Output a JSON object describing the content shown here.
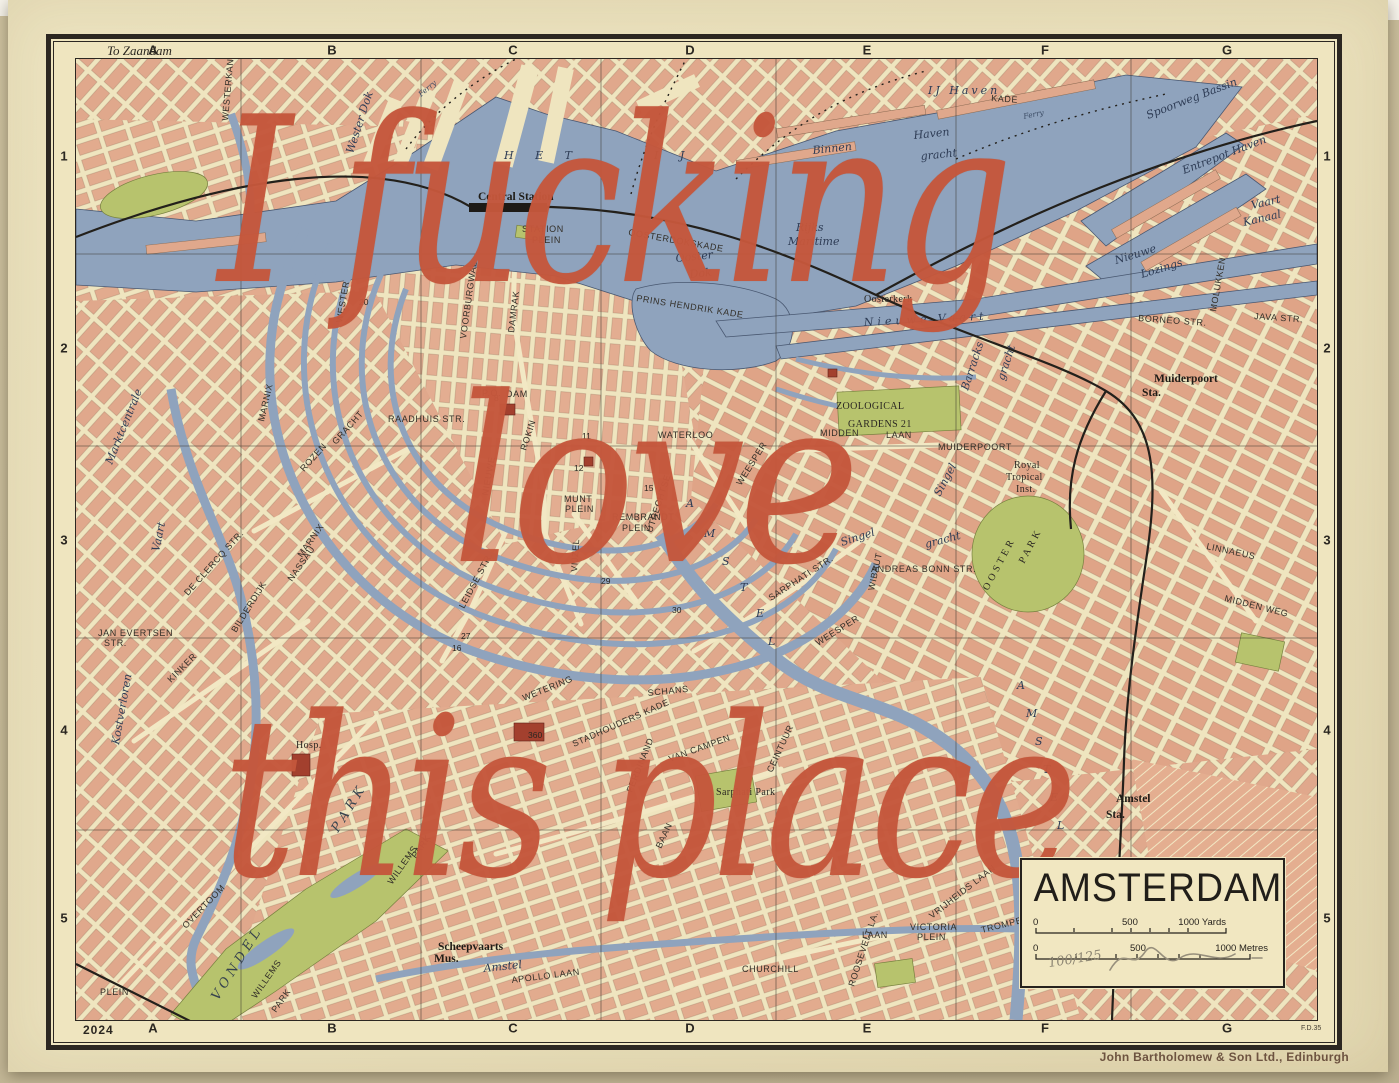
{
  "artwork": {
    "overlay": {
      "line1": "I fucking",
      "line2": "love",
      "line3": "this place"
    },
    "caption": "John Bartholomew & Son Ltd., Edinburgh",
    "edition_number": "100/125"
  },
  "colors": {
    "overlay_accent": "#c5573c",
    "water": "#8fa3bd",
    "building": "#e0a88c",
    "park": "#b7c36d",
    "paper": "#ece3bd",
    "ink": "#2c2721"
  },
  "frame": {
    "to_zaandam": "To Zaandam",
    "plate_year": "2024",
    "plate_ref": "F.D.35",
    "grid_letters": [
      "A",
      "B",
      "C",
      "D",
      "E",
      "F",
      "G"
    ],
    "grid_letter_x": [
      148,
      327,
      508,
      685,
      862,
      1040,
      1222
    ],
    "grid_numbers": [
      "1",
      "2",
      "3",
      "4",
      "5"
    ],
    "grid_number_y": [
      153,
      345,
      537,
      727,
      915
    ]
  },
  "title_box": {
    "title": "AMSTERDAM",
    "yards_zero": "0",
    "yards_mid": "500",
    "yards_end": "1000 Yards",
    "metres_zero": "0",
    "metres_mid": "500",
    "metres_end": "1000 Metres"
  },
  "map_labels": [
    {
      "t": "Wester Dok",
      "x": 277,
      "y": 95,
      "r": -72,
      "f": "w"
    },
    {
      "t": "H E T",
      "x": 428,
      "y": 100,
      "f": "w",
      "s": 15,
      "ls": 9
    },
    {
      "t": "I J",
      "x": 578,
      "y": 100,
      "f": "w",
      "s": 15,
      "ls": 9
    },
    {
      "t": "IJ  Haven",
      "x": 852,
      "y": 35,
      "f": "w",
      "s": 13,
      "ls": 3
    },
    {
      "t": "Ferry",
      "x": 345,
      "y": 38,
      "r": -40,
      "f": "fy"
    },
    {
      "t": "Ferry",
      "x": 948,
      "y": 60,
      "r": -12,
      "f": "fy"
    },
    {
      "t": "KADE",
      "x": 915,
      "y": 42,
      "r": 4,
      "f": "st",
      "s": 7.5
    },
    {
      "t": "Binnen",
      "x": 737,
      "y": 95,
      "r": -6,
      "f": "w"
    },
    {
      "t": "Haven",
      "x": 838,
      "y": 80,
      "r": -6,
      "f": "w"
    },
    {
      "t": "gracht",
      "x": 845,
      "y": 101,
      "r": -6,
      "f": "w"
    },
    {
      "t": "Ooster",
      "x": 600,
      "y": 203,
      "r": -6,
      "f": "w"
    },
    {
      "t": "Dok",
      "x": 614,
      "y": 219,
      "r": -6,
      "f": "w"
    },
    {
      "t": "Rijks",
      "x": 720,
      "y": 172,
      "f": "w"
    },
    {
      "t": "Maritime",
      "x": 712,
      "y": 186,
      "f": "w"
    },
    {
      "t": "Oosterkerk",
      "x": 788,
      "y": 243,
      "f": "sf",
      "s": 9.5
    },
    {
      "t": "Nieuwe    Vaart",
      "x": 788,
      "y": 267,
      "r": -3,
      "f": "w",
      "ls": 4
    },
    {
      "t": "Spoorweg  Bassin",
      "x": 1072,
      "y": 60,
      "r": -21,
      "f": "w"
    },
    {
      "t": "Entrepot  Haven",
      "x": 1108,
      "y": 115,
      "r": -21,
      "f": "w",
      "s": 12
    },
    {
      "t": "Vaart",
      "x": 1176,
      "y": 150,
      "r": -13,
      "f": "w"
    },
    {
      "t": "Kanaal",
      "x": 1168,
      "y": 167,
      "r": -13,
      "f": "w"
    },
    {
      "t": "Nieuwe",
      "x": 1040,
      "y": 205,
      "r": -17,
      "f": "w",
      "s": 10
    },
    {
      "t": "Lozings",
      "x": 1066,
      "y": 219,
      "r": -17,
      "f": "w",
      "s": 10
    },
    {
      "t": "BORNEO  STR.",
      "x": 1062,
      "y": 262,
      "r": 4,
      "f": "st",
      "s": 8
    },
    {
      "t": "JAVA  STR.",
      "x": 1178,
      "y": 260,
      "r": 4,
      "f": "st",
      "s": 8
    },
    {
      "t": "MOLUKKEN",
      "x": 1140,
      "y": 253,
      "r": -80,
      "f": "st",
      "s": 8
    },
    {
      "t": "Central Station",
      "x": 402,
      "y": 141,
      "f": "sfb"
    },
    {
      "t": "STATION",
      "x": 446,
      "y": 173,
      "f": "st",
      "s": 8
    },
    {
      "t": "PLEIN",
      "x": 456,
      "y": 184,
      "f": "st",
      "s": 8
    },
    {
      "t": "OOSTERDOKSKADE",
      "x": 552,
      "y": 176,
      "r": 10,
      "f": "st",
      "s": 7.5
    },
    {
      "t": "PRINS  HENDRIK  KADE",
      "x": 560,
      "y": 242,
      "r": 9,
      "f": "st",
      "s": 8
    },
    {
      "t": "DAMRAK",
      "x": 438,
      "y": 274,
      "r": -83,
      "f": "st"
    },
    {
      "t": "VOORBURGWAL",
      "x": 390,
      "y": 280,
      "r": -82,
      "f": "st",
      "s": 8
    },
    {
      "t": "WESTER",
      "x": 266,
      "y": 264,
      "r": -80,
      "f": "st",
      "s": 8
    },
    {
      "t": "WESTERKANAAL",
      "x": 152,
      "y": 62,
      "r": -85,
      "f": "st",
      "s": 7
    },
    {
      "t": "RAADHUIS  STR.",
      "x": 312,
      "y": 363,
      "f": "st",
      "s": 8.5
    },
    {
      "t": "P.O.",
      "x": 406,
      "y": 337,
      "f": "st",
      "s": 8
    },
    {
      "t": "DAM",
      "x": 430,
      "y": 338,
      "f": "st"
    },
    {
      "t": "ROKIN",
      "x": 450,
      "y": 392,
      "r": -72,
      "f": "st"
    },
    {
      "t": "NIEUWE",
      "x": 412,
      "y": 437,
      "r": -80,
      "f": "st",
      "s": 8
    },
    {
      "t": "MARNIX",
      "x": 188,
      "y": 363,
      "r": -77,
      "f": "st"
    },
    {
      "t": "MARNIX",
      "x": 226,
      "y": 499,
      "r": -55,
      "f": "st"
    },
    {
      "t": "NASSAU",
      "x": 216,
      "y": 523,
      "r": -55,
      "f": "st"
    },
    {
      "t": "ROZEN",
      "x": 228,
      "y": 413,
      "r": -48,
      "f": "st"
    },
    {
      "t": "GRACHT",
      "x": 260,
      "y": 386,
      "r": -48,
      "f": "st"
    },
    {
      "t": "Marktcentrale",
      "x": 36,
      "y": 406,
      "r": -68,
      "f": "w"
    },
    {
      "t": "Vaart",
      "x": 83,
      "y": 493,
      "r": -78,
      "f": "w"
    },
    {
      "t": "Kostverloren",
      "x": 43,
      "y": 686,
      "r": -80,
      "f": "w",
      "s": 10
    },
    {
      "t": "JAN EVERTSEN",
      "x": 22,
      "y": 577,
      "f": "st",
      "s": 7.5
    },
    {
      "t": "STR.",
      "x": 28,
      "y": 587,
      "f": "st",
      "s": 7.5
    },
    {
      "t": "DE  CLERCQ  STR.",
      "x": 112,
      "y": 537,
      "r": -48,
      "f": "st",
      "s": 8.5
    },
    {
      "t": "BILDERDIJK",
      "x": 160,
      "y": 574,
      "r": -58,
      "f": "st",
      "s": 8.5
    },
    {
      "t": "KINKER",
      "x": 95,
      "y": 624,
      "r": -45,
      "f": "st"
    },
    {
      "t": "OVERTOOM",
      "x": 110,
      "y": 870,
      "r": -46,
      "f": "st",
      "s": 10
    },
    {
      "t": "V O N D E L",
      "x": 142,
      "y": 942,
      "r": -58,
      "f": "wi"
    },
    {
      "t": "P A R K",
      "x": 262,
      "y": 774,
      "r": -58,
      "f": "wi",
      "s": 12
    },
    {
      "t": "WILLEMS",
      "x": 316,
      "y": 826,
      "r": -55,
      "f": "st"
    },
    {
      "t": "PARK",
      "x": 340,
      "y": 800,
      "r": -55,
      "f": "st"
    },
    {
      "t": "WILLEMS",
      "x": 180,
      "y": 940,
      "r": -55,
      "f": "st",
      "s": 8.5
    },
    {
      "t": "PARK",
      "x": 200,
      "y": 954,
      "r": -55,
      "f": "st",
      "s": 8.5
    },
    {
      "t": "PLEIN",
      "x": 24,
      "y": 936,
      "f": "st",
      "s": 7.5
    },
    {
      "t": "Scheepvaarts",
      "x": 362,
      "y": 891,
      "f": "sfb",
      "s": 10.5
    },
    {
      "t": "Mus.",
      "x": 358,
      "y": 903,
      "f": "sfb",
      "s": 10.5
    },
    {
      "t": "Amstel",
      "x": 408,
      "y": 913,
      "r": -6,
      "f": "w",
      "c": "#2c4470"
    },
    {
      "t": "APOLLO  LAAN",
      "x": 436,
      "y": 924,
      "r": -7,
      "f": "st"
    },
    {
      "t": "WETERING",
      "x": 448,
      "y": 642,
      "r": -22,
      "f": "st"
    },
    {
      "t": "SCHANS",
      "x": 572,
      "y": 637,
      "r": -6,
      "f": "st"
    },
    {
      "t": "STADHOUDERS KADE",
      "x": 498,
      "y": 688,
      "r": -24,
      "f": "st",
      "s": 7.5
    },
    {
      "t": "LEIDSE STR.",
      "x": 388,
      "y": 550,
      "r": -62,
      "f": "st",
      "s": 8.5
    },
    {
      "t": "VIJZEL",
      "x": 501,
      "y": 513,
      "r": -86,
      "f": "st"
    },
    {
      "t": "UTRECHTSE",
      "x": 576,
      "y": 474,
      "r": -72,
      "f": "st",
      "s": 8
    },
    {
      "t": "MUNT",
      "x": 488,
      "y": 443,
      "f": "st",
      "s": 7.5
    },
    {
      "t": "PLEIN",
      "x": 489,
      "y": 453,
      "f": "st",
      "s": 7.5
    },
    {
      "t": "REMBRANDT",
      "x": 536,
      "y": 461,
      "f": "st",
      "s": 8
    },
    {
      "t": "PLEIN",
      "x": 546,
      "y": 472,
      "f": "st",
      "s": 8
    },
    {
      "t": "WATERLOO",
      "x": 582,
      "y": 379,
      "f": "st",
      "s": 8
    },
    {
      "t": "WEESPER",
      "x": 665,
      "y": 427,
      "r": -58,
      "f": "st"
    },
    {
      "t": "WEESPER",
      "x": 742,
      "y": 587,
      "r": -32,
      "f": "st",
      "s": 8.5
    },
    {
      "t": "SARPHATI  STR.",
      "x": 695,
      "y": 542,
      "r": -33,
      "f": "st",
      "s": 8.5
    },
    {
      "t": "ANDREAS BONN STR.",
      "x": 795,
      "y": 513,
      "f": "st",
      "s": 8
    },
    {
      "t": "WIBAUT",
      "x": 798,
      "y": 532,
      "r": -78,
      "f": "st"
    },
    {
      "t": "Singel",
      "x": 766,
      "y": 487,
      "r": -18,
      "f": "w"
    },
    {
      "t": "gracht",
      "x": 850,
      "y": 489,
      "r": -15,
      "f": "w"
    },
    {
      "t": "Singel",
      "x": 864,
      "y": 438,
      "r": -62,
      "f": "w",
      "s": 10
    },
    {
      "t": "gracht",
      "x": 928,
      "y": 322,
      "r": -72,
      "f": "w",
      "s": 10
    },
    {
      "t": "Barracks",
      "x": 892,
      "y": 332,
      "r": -72,
      "f": "w"
    },
    {
      "t": "ZOOLOGICAL",
      "x": 760,
      "y": 350,
      "f": "sf",
      "ls": 3,
      "s": 11
    },
    {
      "t": "GARDENS  21",
      "x": 772,
      "y": 368,
      "f": "sf",
      "ls": 3,
      "s": 11
    },
    {
      "t": "MIDDEN",
      "x": 744,
      "y": 377,
      "f": "st"
    },
    {
      "t": "LAAN",
      "x": 810,
      "y": 379,
      "f": "st"
    },
    {
      "t": "MUIDERPOORT",
      "x": 862,
      "y": 391,
      "f": "st",
      "s": 7
    },
    {
      "t": "Muiderpoort",
      "x": 1078,
      "y": 323,
      "f": "sfb"
    },
    {
      "t": "Sta.",
      "x": 1066,
      "y": 337,
      "f": "sfb"
    },
    {
      "t": "Royal",
      "x": 938,
      "y": 409,
      "f": "sf",
      "s": 9.5
    },
    {
      "t": "Tropical",
      "x": 930,
      "y": 421,
      "f": "sf",
      "s": 9.5
    },
    {
      "t": "Inst.",
      "x": 940,
      "y": 433,
      "f": "sf",
      "s": 9.5
    },
    {
      "t": "O O S T E R",
      "x": 912,
      "y": 532,
      "r": -62,
      "f": "sf",
      "s": 11
    },
    {
      "t": "P A R K",
      "x": 948,
      "y": 505,
      "r": -62,
      "f": "sf",
      "s": 11
    },
    {
      "t": "LINNAEUS",
      "x": 1130,
      "y": 490,
      "r": 12,
      "f": "st",
      "s": 8.5
    },
    {
      "t": "MIDDEN  WEG",
      "x": 1148,
      "y": 542,
      "r": 14,
      "f": "st",
      "s": 8.5
    },
    {
      "t": "A",
      "x": 610,
      "y": 448,
      "f": "w",
      "s": 12
    },
    {
      "t": "M",
      "x": 628,
      "y": 478,
      "f": "w",
      "s": 12
    },
    {
      "t": "S",
      "x": 646,
      "y": 506,
      "f": "w",
      "s": 12
    },
    {
      "t": "T",
      "x": 664,
      "y": 532,
      "f": "w",
      "s": 12
    },
    {
      "t": "E",
      "x": 680,
      "y": 558,
      "f": "w",
      "s": 12
    },
    {
      "t": "L",
      "x": 692,
      "y": 586,
      "f": "w",
      "s": 12
    },
    {
      "t": "A",
      "x": 941,
      "y": 630,
      "f": "w",
      "s": 12
    },
    {
      "t": "M",
      "x": 950,
      "y": 658,
      "f": "w",
      "s": 12
    },
    {
      "t": "S",
      "x": 959,
      "y": 686,
      "f": "w",
      "s": 12
    },
    {
      "t": "T",
      "x": 967,
      "y": 714,
      "f": "w",
      "s": 12
    },
    {
      "t": "E",
      "x": 974,
      "y": 742,
      "f": "w",
      "s": 12
    },
    {
      "t": "L",
      "x": 981,
      "y": 770,
      "f": "w",
      "s": 12
    },
    {
      "t": "Sarphati Park",
      "x": 640,
      "y": 736,
      "f": "sf",
      "s": 9.5
    },
    {
      "t": "Hosp.",
      "x": 220,
      "y": 689,
      "f": "sf"
    },
    {
      "t": "CEINTUUR",
      "x": 696,
      "y": 714,
      "r": -65,
      "f": "st",
      "s": 8.5
    },
    {
      "t": "BAAN",
      "x": 585,
      "y": 790,
      "r": -65,
      "f": "st",
      "s": 8.5
    },
    {
      "t": "FERDINAND",
      "x": 556,
      "y": 734,
      "r": -68,
      "f": "st",
      "s": 8
    },
    {
      "t": "VAN CAMPEN",
      "x": 594,
      "y": 703,
      "r": -20,
      "f": "st",
      "s": 7.5
    },
    {
      "t": "CHURCHILL",
      "x": 666,
      "y": 913,
      "f": "st",
      "s": 10
    },
    {
      "t": "LAAN",
      "x": 786,
      "y": 879,
      "f": "st",
      "s": 9.5
    },
    {
      "t": "VICTORIA",
      "x": 834,
      "y": 871,
      "f": "st",
      "s": 7.5
    },
    {
      "t": "PLEIN",
      "x": 841,
      "y": 881,
      "f": "st",
      "s": 7.5
    },
    {
      "t": "ROOSEVELT  LA.",
      "x": 778,
      "y": 928,
      "r": -72,
      "f": "st",
      "s": 8.5
    },
    {
      "t": "VRIJHEIDS  LAAN",
      "x": 856,
      "y": 860,
      "r": -38,
      "f": "st",
      "s": 8.5
    },
    {
      "t": "TROMPENBURG  STR.",
      "x": 906,
      "y": 874,
      "r": -14,
      "f": "st",
      "s": 7.5
    },
    {
      "t": "Amstel",
      "x": 1040,
      "y": 743,
      "f": "sfb"
    },
    {
      "t": "Sta.",
      "x": 1030,
      "y": 759,
      "f": "sfb"
    },
    {
      "t": "20",
      "x": 283,
      "y": 246,
      "f": "n"
    },
    {
      "t": "8",
      "x": 418,
      "y": 342,
      "f": "n"
    },
    {
      "t": "11",
      "x": 506,
      "y": 380,
      "f": "n"
    },
    {
      "t": "12",
      "x": 498,
      "y": 412,
      "f": "n"
    },
    {
      "t": "15",
      "x": 568,
      "y": 432,
      "f": "n"
    },
    {
      "t": "27",
      "x": 385,
      "y": 580,
      "f": "n"
    },
    {
      "t": "16",
      "x": 376,
      "y": 592,
      "f": "n"
    },
    {
      "t": "29",
      "x": 525,
      "y": 525,
      "f": "n"
    },
    {
      "t": "30",
      "x": 596,
      "y": 554,
      "f": "n"
    },
    {
      "t": "360",
      "x": 452,
      "y": 679,
      "f": "n",
      "c": "#ffffff",
      "s": 8
    }
  ]
}
